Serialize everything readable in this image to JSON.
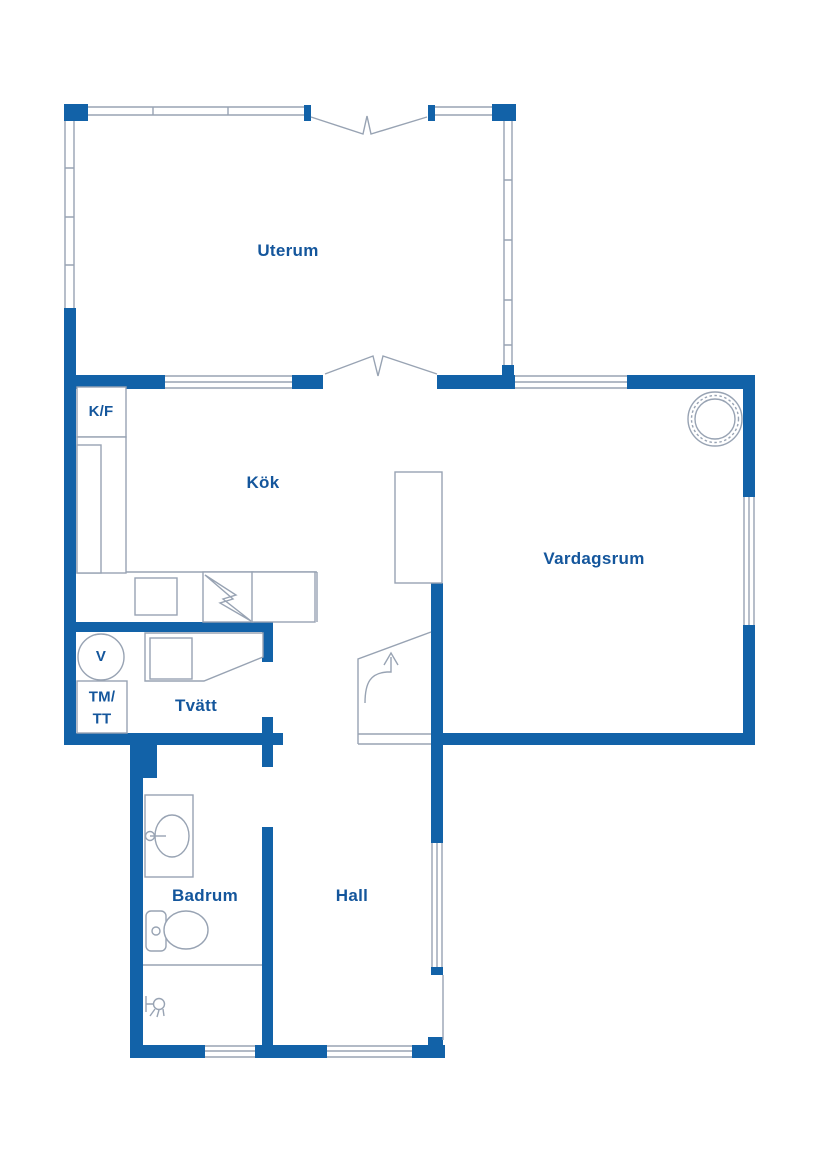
{
  "document": {
    "type": "floor-plan"
  },
  "colors": {
    "wall": "#1262a8",
    "thin_line": "#98a3b3",
    "label_text": "#14569c",
    "background": "#ffffff"
  },
  "rooms": {
    "uterum": {
      "label": "Uterum"
    },
    "kok": {
      "label": "Kök"
    },
    "vardagsrum": {
      "label": "Vardagsrum"
    },
    "tvatt": {
      "label": "Tvätt"
    },
    "badrum": {
      "label": "Badrum"
    },
    "hall": {
      "label": "Hall"
    }
  },
  "fixtures": {
    "fridge_freezer": {
      "label": "K/F"
    },
    "water_heater": {
      "label": "V"
    },
    "washer_dryer": {
      "line1": "TM/",
      "line2": "TT"
    }
  }
}
